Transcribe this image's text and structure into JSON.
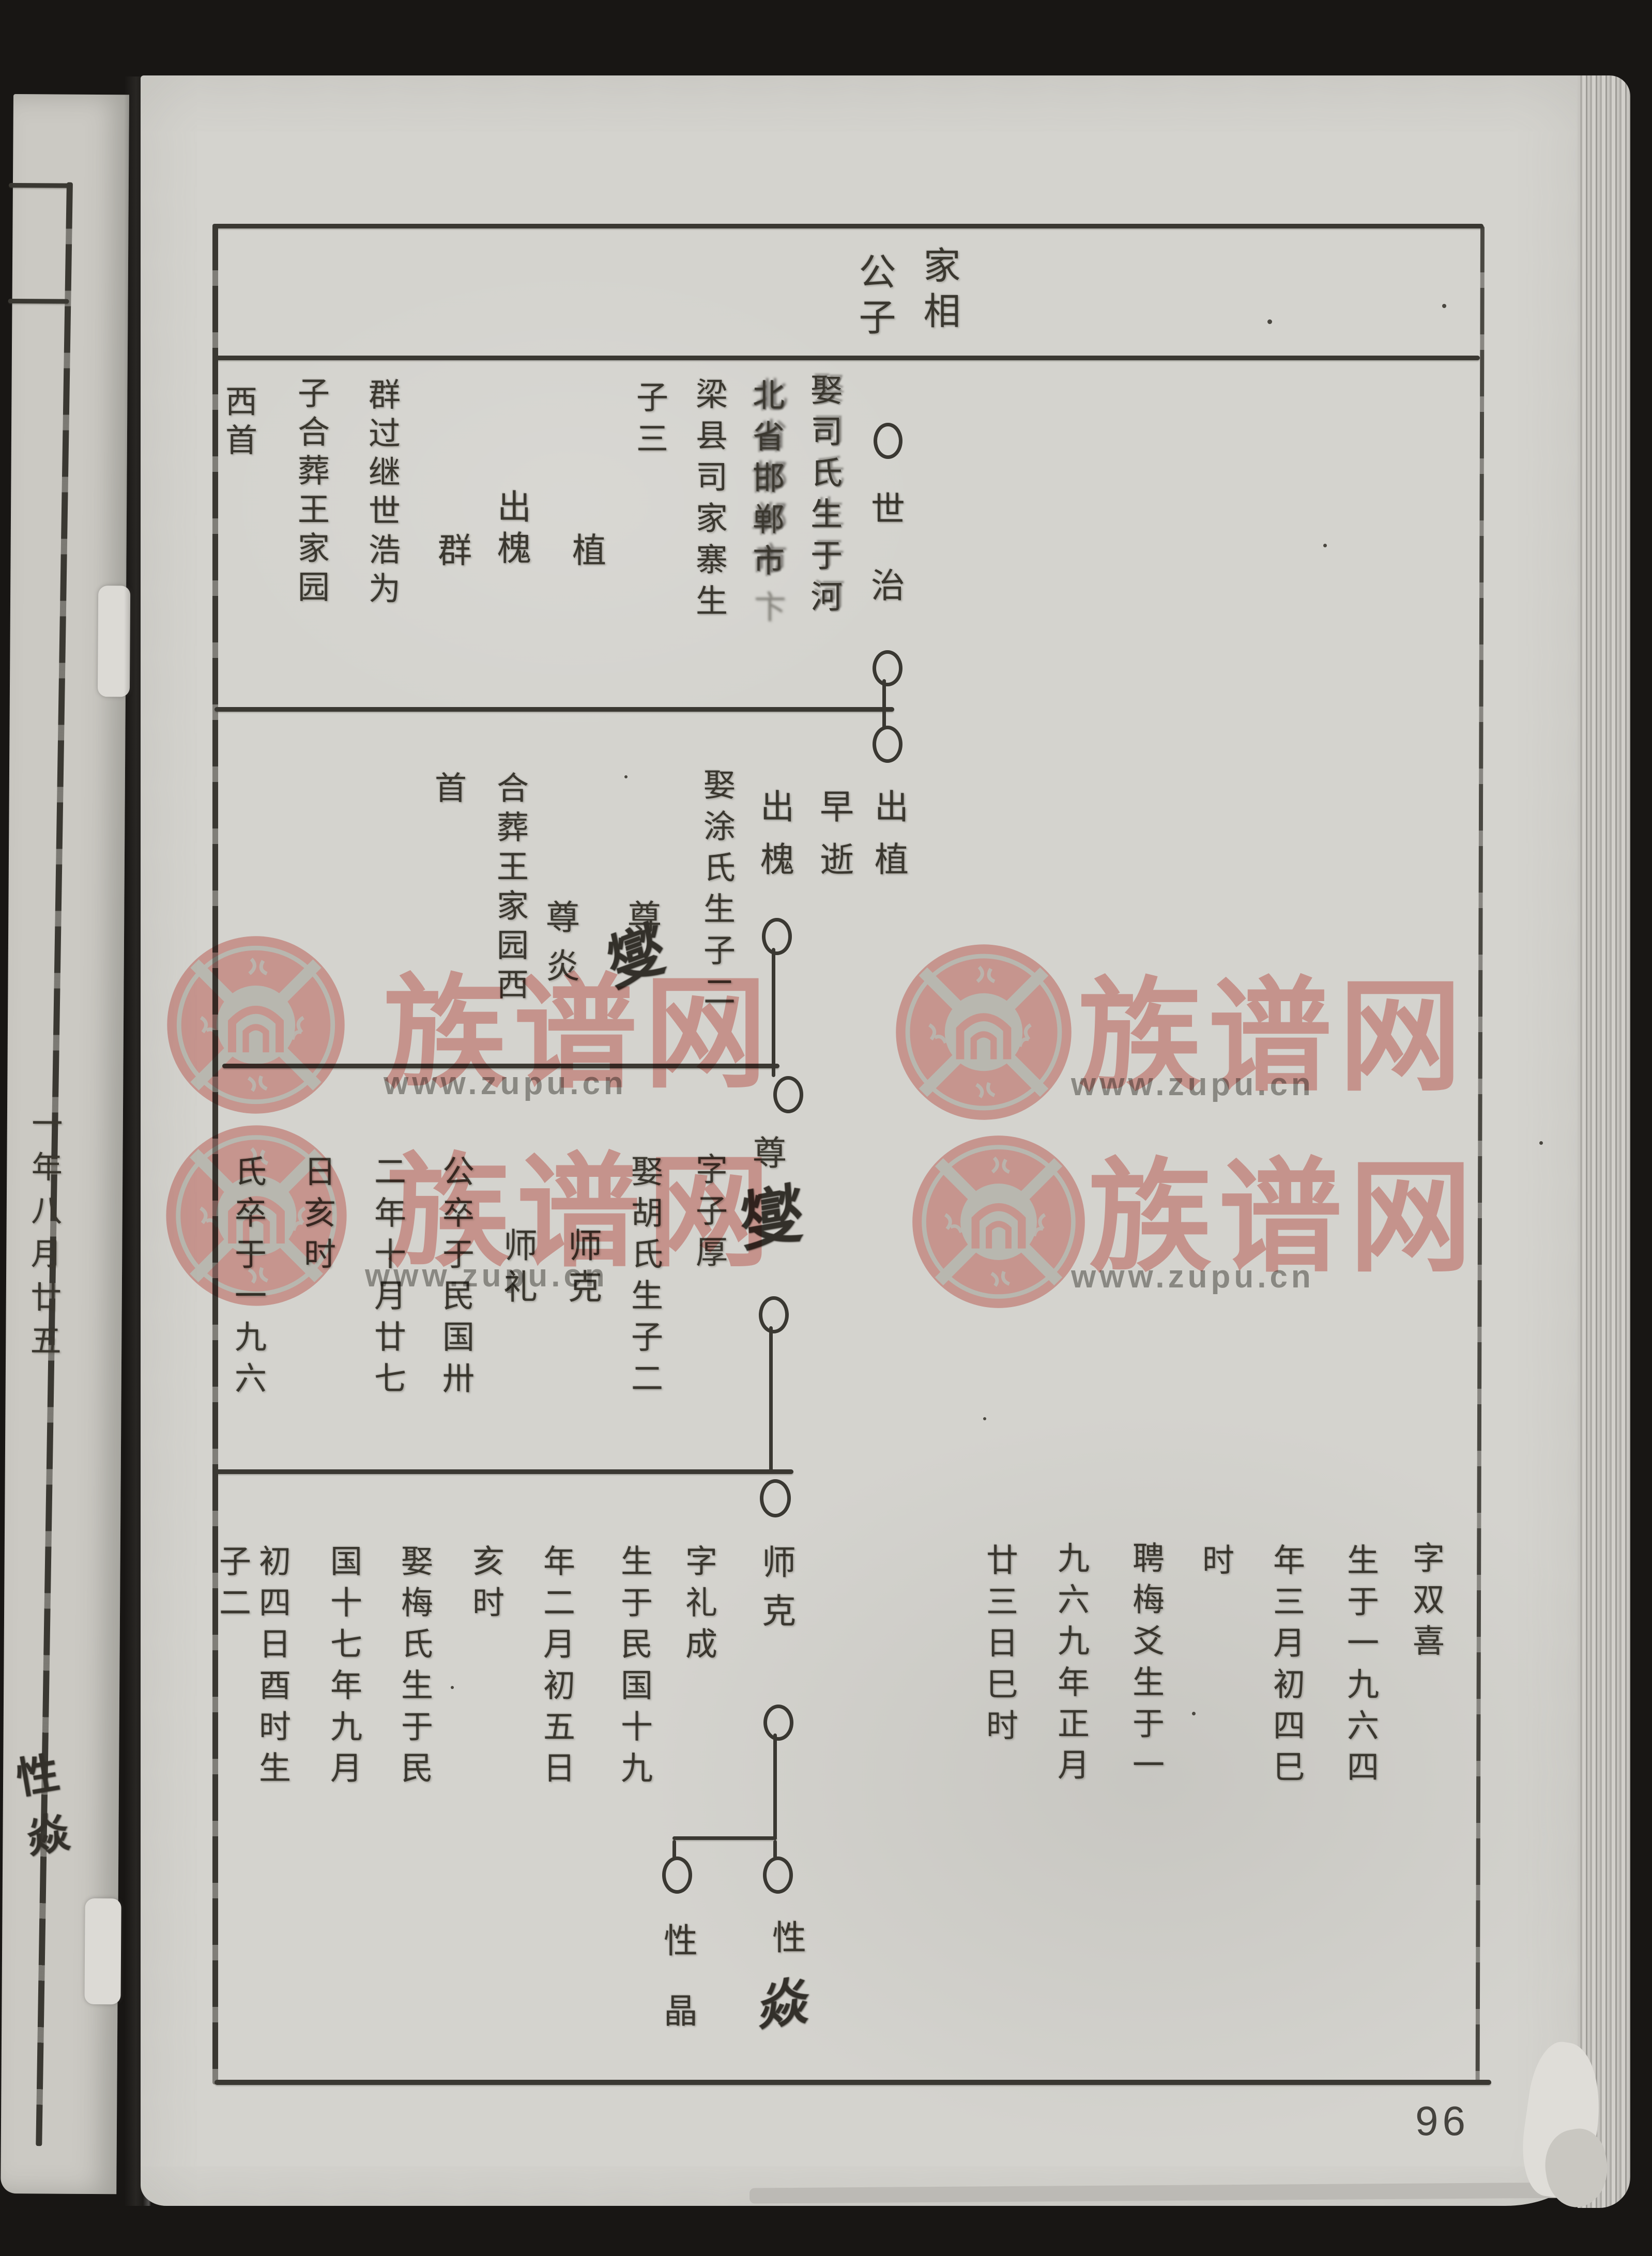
{
  "page_number": "96",
  "watermark": {
    "brand": "族谱网",
    "url": "www.zupu.cn",
    "pink": "#eba7a2",
    "gray": "#8f8d8a"
  },
  "header": {
    "col1": "家相",
    "col2": "公子"
  },
  "gen1": {
    "head": "世治",
    "details": [
      "娶司氏生于河",
      "北省邯郸市",
      "梁县司家寨生",
      "子三"
    ],
    "smudge_char": "卞",
    "sons": [
      "植",
      "出槐",
      "群"
    ],
    "notes": [
      "群过继世浩为",
      "子合葬王家园",
      "西首"
    ]
  },
  "gen2": {
    "entries": [
      "出植",
      "早逝",
      "出槐"
    ],
    "marriage": "娶涂氏生子二",
    "son1_printed": "尊",
    "son1_hand": "燮",
    "son2": "尊炎",
    "burial": [
      "合葬王家园西",
      "首"
    ]
  },
  "gen3": {
    "head_printed": "尊",
    "head_hand": "燮",
    "courtesy": "字子厚",
    "marriage": "娶胡氏生子二",
    "sons": [
      "师克",
      "师礼"
    ],
    "death": [
      "公卒于民国卅",
      "二年十月廿七",
      "日亥时",
      "氏卒于一九六"
    ]
  },
  "entry_right": [
    "字双喜",
    "生于一九六四",
    "年三月初四巳",
    "时",
    "聘梅爻生于一",
    "九六九年正月",
    "廿三日巳时"
  ],
  "gen4": {
    "head": "师克",
    "courtesy": "字礼成",
    "details": [
      "生于民国十九",
      "年二月初五日",
      "亥时",
      "娶梅氏生于民",
      "国十七年九月",
      "初四日酉时生",
      "子二"
    ],
    "child_left": "性晶",
    "child_right_printed": "性",
    "child_right_hand": "焱"
  },
  "adjacent_page": {
    "date_fragment": "一年八月廿五",
    "hand_note": "性焱"
  }
}
